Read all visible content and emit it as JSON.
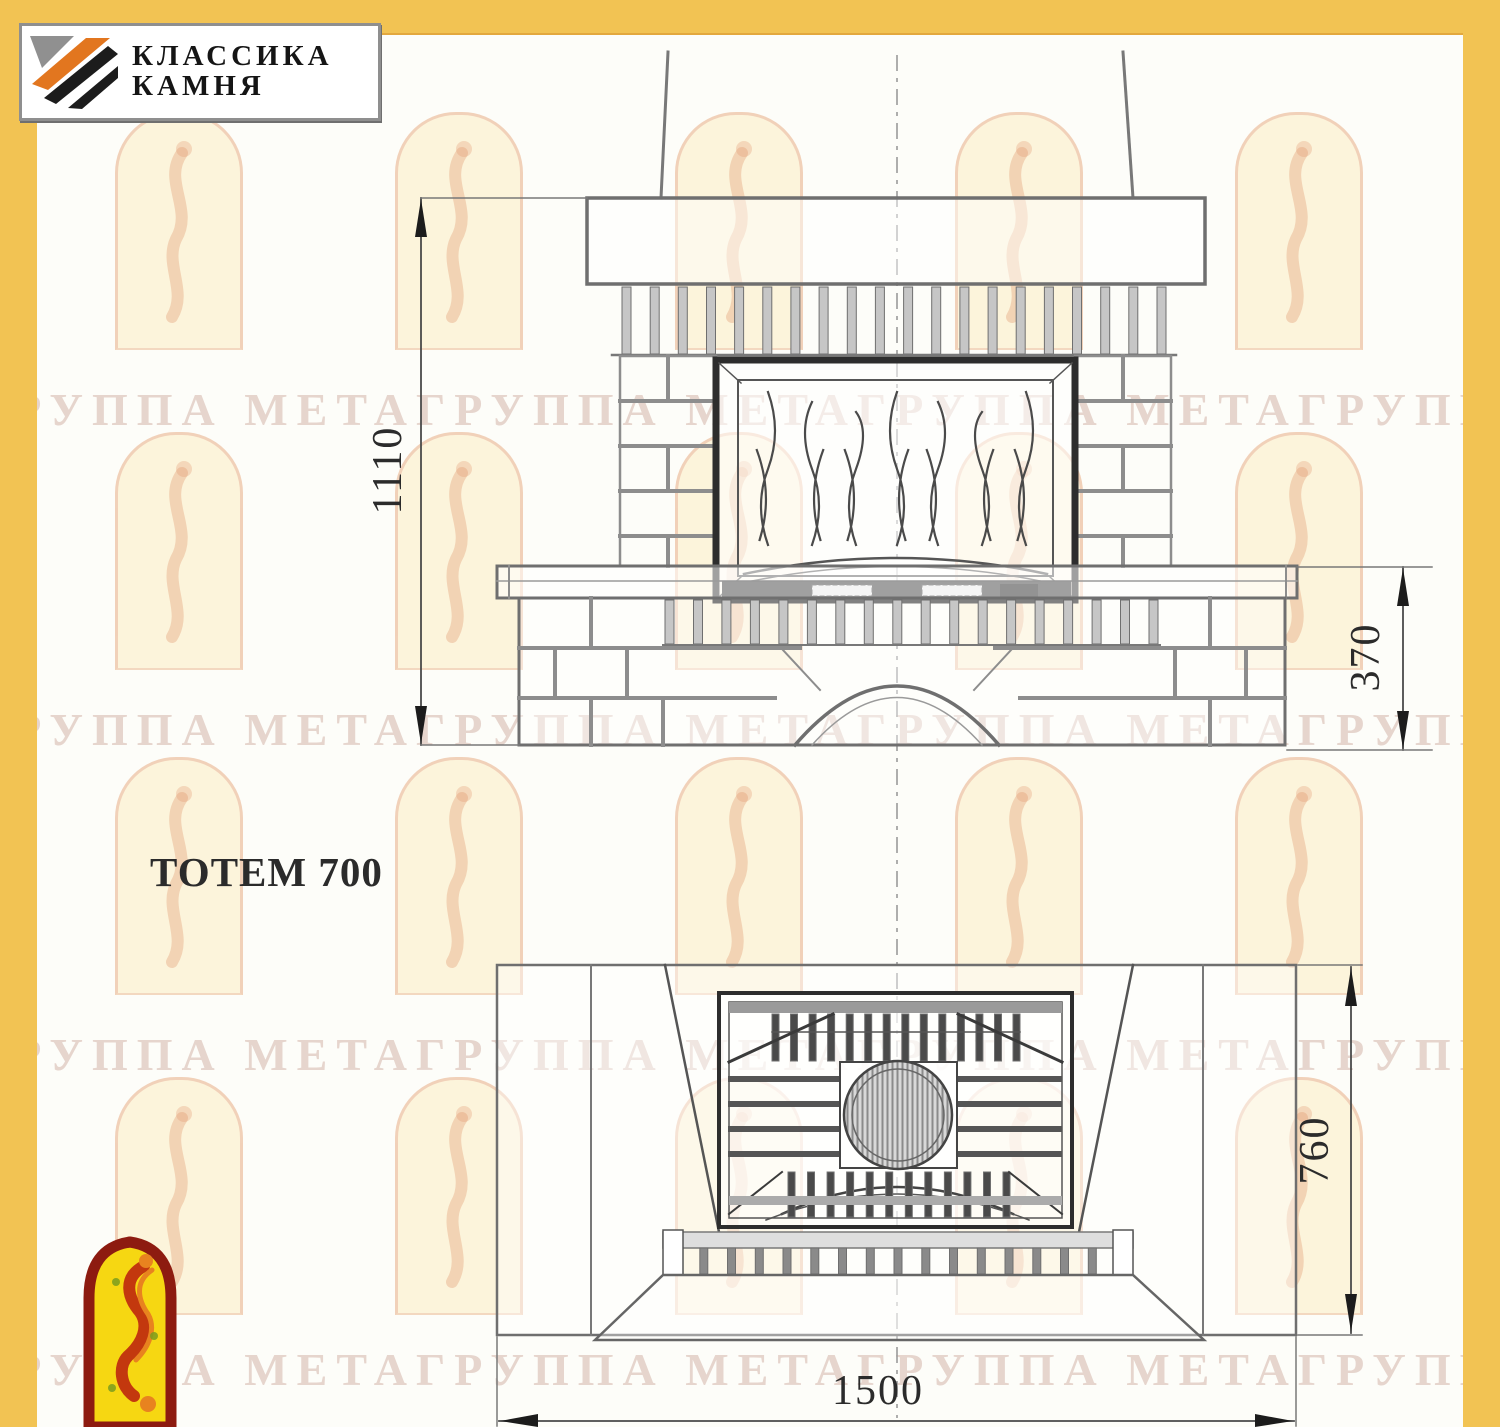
{
  "page": {
    "background": "#fdfdf9",
    "accent_yellow": "#f2c353",
    "line_gray": "#6f6f6f",
    "dark_line": "#2d2d2d"
  },
  "logo": {
    "line1": "КЛАССИКА",
    "line2": "КАМНЯ",
    "icon": "diagonal-stone-stripes-icon",
    "stripe_colors": [
      "#909090",
      "#e2761f",
      "#1c1c1c"
    ]
  },
  "drawing": {
    "title": "ТОТЕМ 700",
    "dimensions": {
      "overall_height": "1110",
      "bench_height": "370",
      "depth": "760",
      "width": "1500"
    }
  },
  "watermark": {
    "text": "ГРУППА МЕТАГРУППА МЕТАГРУППА МЕТАГРУППА МЕТА",
    "emblem": "arch-figure-watermark"
  },
  "footer_emblem": "jester-in-arch-emblem"
}
